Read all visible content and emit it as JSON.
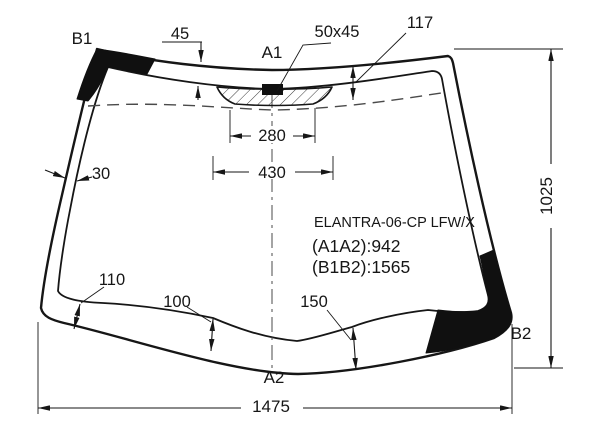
{
  "title_block": {
    "part": "ELANTRA-06-CP LFW/X",
    "a1a2": "(A1A2):942",
    "b1b2": "(B1B2):1565"
  },
  "labels": {
    "b1": "B1",
    "a1": "A1",
    "a2": "A2",
    "b2": "B2"
  },
  "dims": {
    "top_band": "45",
    "pad_size": "50x45",
    "right_top_band": "117",
    "pad_inner_width": "280",
    "pad_outer_width": "430",
    "left_band": "30",
    "bottom_left_band": "110",
    "bottom_center_band": "100",
    "bottom_right_band": "150",
    "overall_width": "1475",
    "overall_height": "1025"
  },
  "colors": {
    "ink": "#161616",
    "background": "#ffffff"
  }
}
